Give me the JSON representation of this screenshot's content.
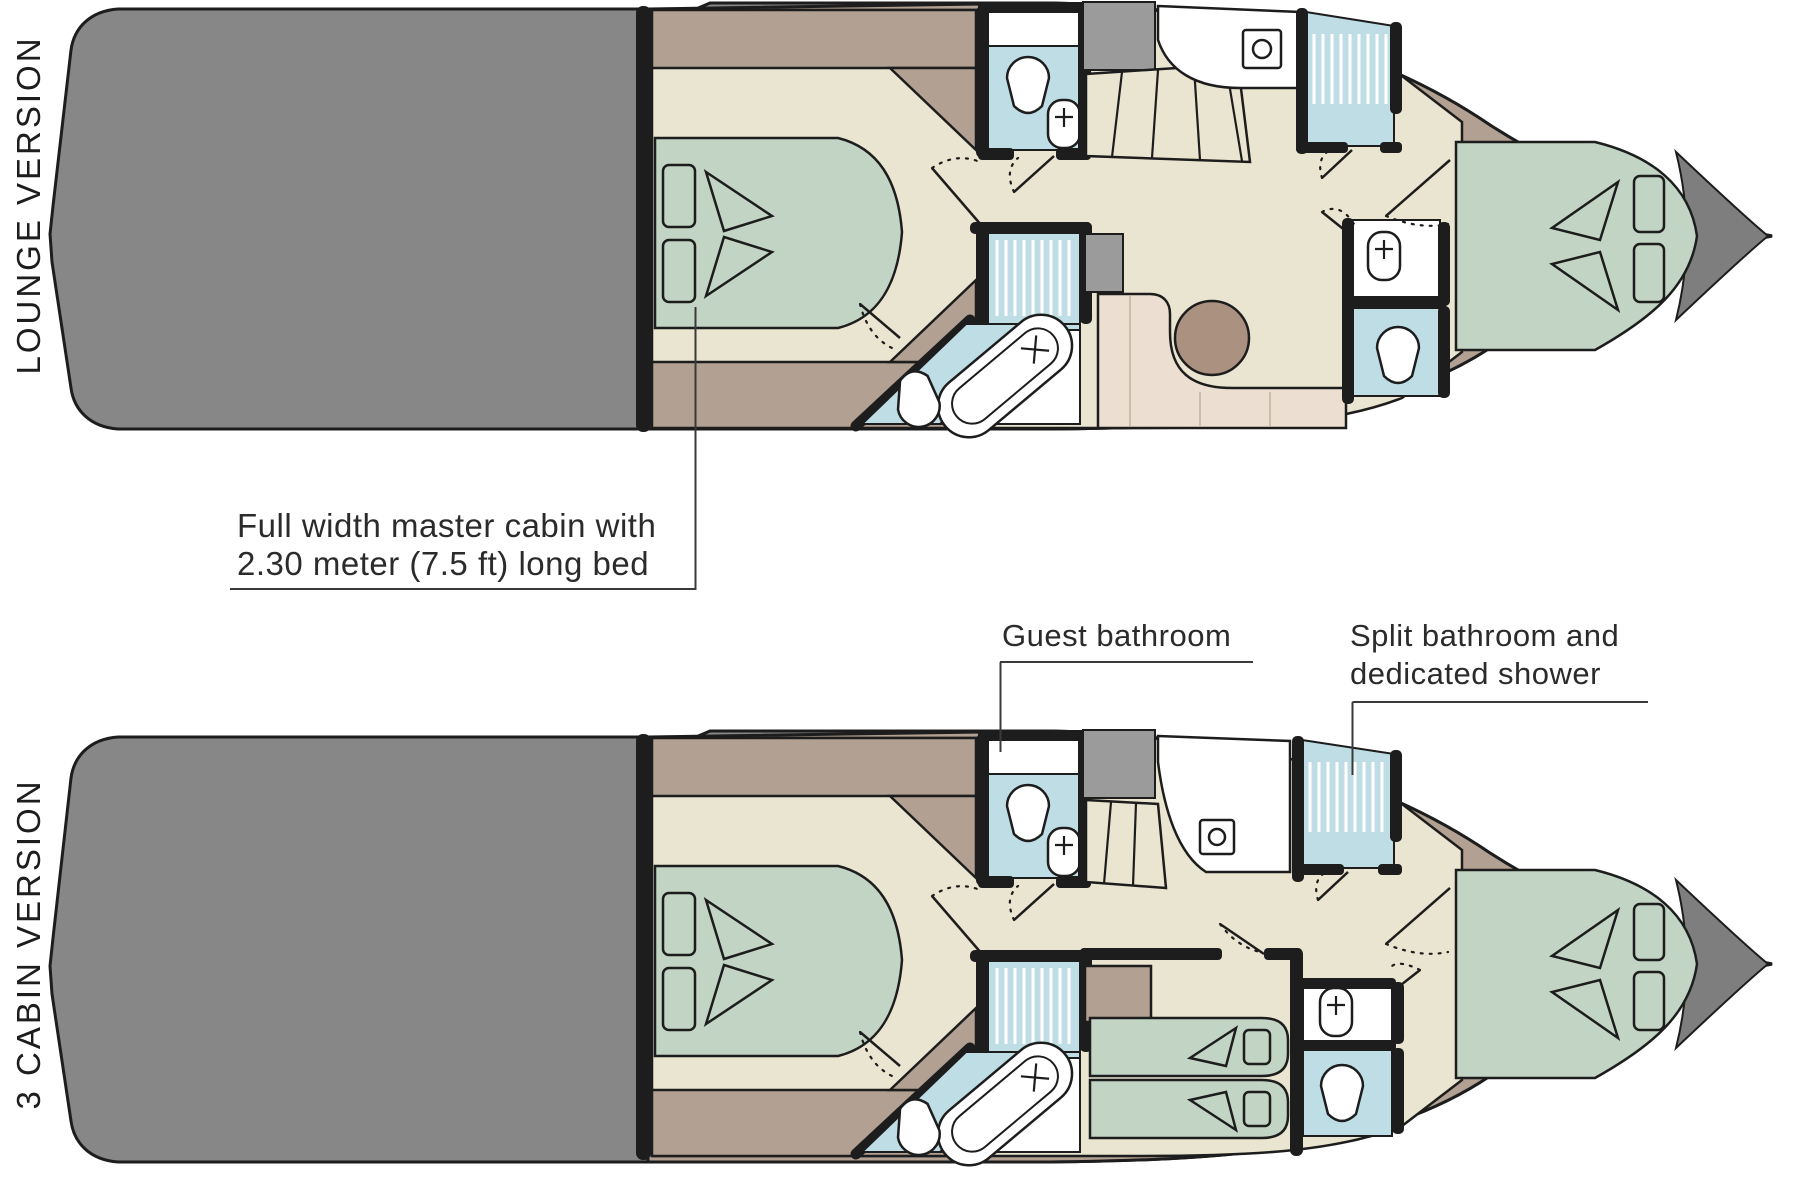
{
  "plans": [
    {
      "id": "lounge",
      "label": "LOUNGE VERSION"
    },
    {
      "id": "three-cabin",
      "label": "3 CABIN VERSION"
    }
  ],
  "annotations": {
    "master_cabin": {
      "line1": "Full width master cabin with",
      "line2": "2.30 meter (7.5 ft) long bed"
    },
    "guest_bathroom": {
      "label": "Guest bathroom"
    },
    "split_bathroom": {
      "line1": "Split bathroom and",
      "line2": "dedicated shower"
    }
  },
  "icons": [
    "double-bed-icon",
    "single-bed-icon",
    "pillow-icon",
    "toilet-icon",
    "sink-icon",
    "shower-stall-icon",
    "bathtub-icon",
    "stairs-icon",
    "dinette-table-icon"
  ],
  "colors": {
    "hull_grey": "#878787",
    "deck_taupe": "#b2a193",
    "floor_cream": "#eae5d0",
    "bed_green": "#c2d5c5",
    "bath_blue": "#bfdde5",
    "sofa_cream": "#ecdfd2",
    "table_brown": "#ab9180",
    "tech_grey": "#9b9b9b",
    "bow_tip_grey": "#7e7e7e",
    "wall_black": "#1d1d1d",
    "text": "#2b2b2b"
  }
}
